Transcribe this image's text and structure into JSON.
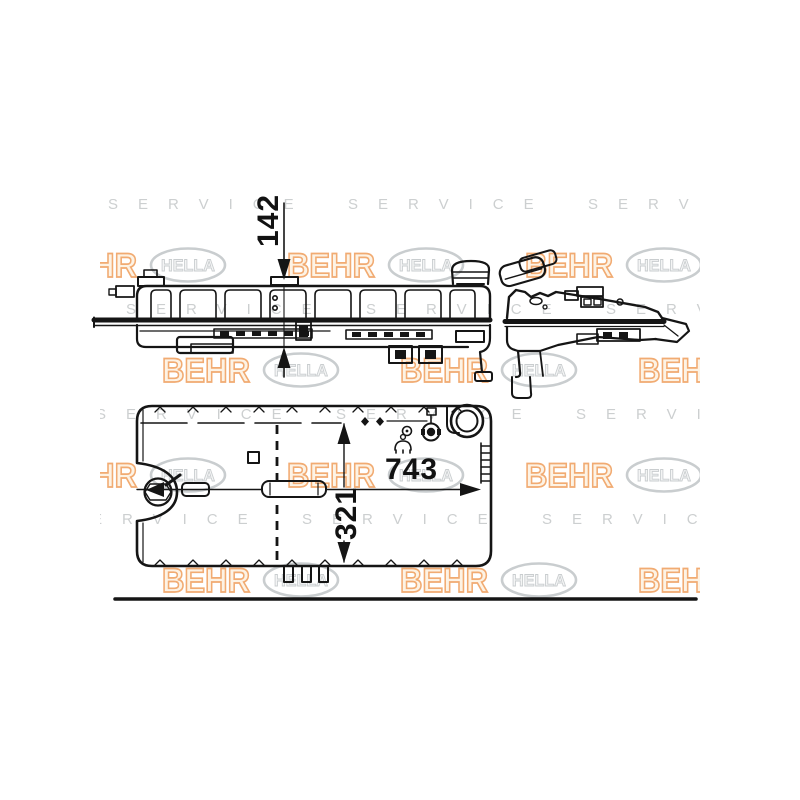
{
  "watermark": {
    "behr_label": "BEHR",
    "hella_label": "HELLA",
    "service_label": "SERVICE",
    "behr_orange": "#F0A263",
    "hella_gray": "#C4C8CA"
  },
  "dimensions": {
    "vertical_height_mm": "142",
    "overall_length_mm": "743",
    "overall_width_mm": "321"
  },
  "colors": {
    "background": "#FFFFFF",
    "line_color": "#151515"
  }
}
